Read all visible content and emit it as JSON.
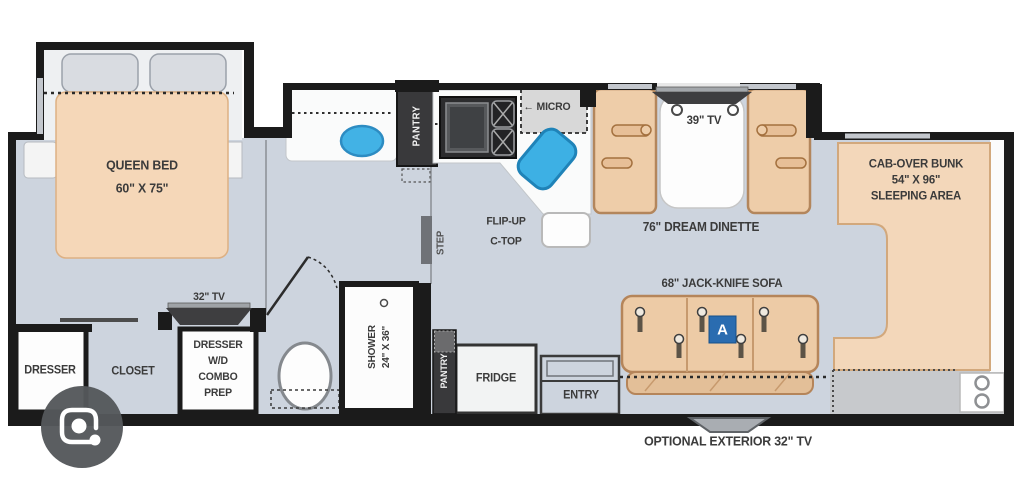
{
  "floorplan": {
    "labels": {
      "queen_bed": [
        "QUEEN BED",
        "60\" X 75\""
      ],
      "bedroom_tv": "32\" TV",
      "dresser": "DRESSER",
      "closet": "CLOSET",
      "dresser_wd": [
        "DRESSER",
        "W/D",
        "COMBO",
        "PREP"
      ],
      "shower": [
        "SHOWER",
        "24\" X 36\""
      ],
      "pantry_upper": "PANTRY",
      "pantry_lower": "PANTRY",
      "step": "STEP",
      "flip_up": [
        "FLIP-UP",
        "C-TOP"
      ],
      "micro_arrow": "←",
      "micro": "MICRO",
      "dinette_tv": "39\" TV",
      "dinette": "76\" DREAM DINETTE",
      "cab_over": [
        "CAB-OVER BUNK",
        "54\" X 96\"",
        "SLEEPING AREA"
      ],
      "sofa": "68\" JACK-KNIFE SOFA",
      "sofa_seat_badge": "A",
      "fridge": "FRIDGE",
      "entry": "ENTRY",
      "exterior_tv": "OPTIONAL EXTERIOR 32\" TV"
    },
    "colors": {
      "wall": "#1b1b1b",
      "floor": "#cdd4de",
      "furniture_tan": "#f3d6b8",
      "sink_blue": "#42b2e5",
      "badge_blue": "#2a6cb0"
    }
  },
  "overlay": {
    "lens_button": "google-lens-camera"
  }
}
